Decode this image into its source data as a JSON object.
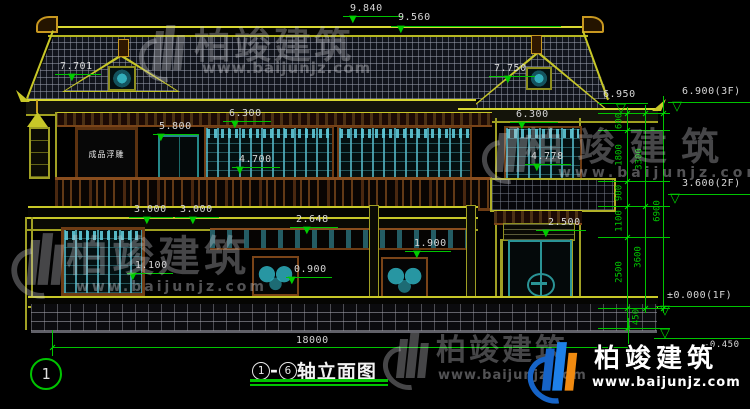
{
  "drawing": {
    "title": {
      "axis_from": "1",
      "axis_to": "6",
      "separator": "-",
      "name": "轴立面图"
    },
    "axis_bubble_label": "1",
    "relief_panel_label": "成品浮雕"
  },
  "levels": {
    "ridge_main": "9.840",
    "ridge_right": "9.560",
    "gable_left": "7.701",
    "gable_right": "7.750",
    "eave_right": "6.950",
    "floor3": "6.900(3F)",
    "floor2": "3.600(2F)",
    "floor1": "±0.000(1F)",
    "ground": "-0.450"
  },
  "facade_dims": {
    "eave_left": "6.300",
    "eave_left2": "6.300",
    "door_2f": "5.800",
    "window_2f": "4.700",
    "window_3f": "4.778",
    "bay1": "3.000",
    "bay2": "3.000",
    "porch_rail": "2.648",
    "door_1f": "2.500",
    "panel_b": "1.900",
    "window_1f": "1.100",
    "panel_a": "0.900",
    "total_width": "18000"
  },
  "chain_dims": {
    "c600": "600",
    "c1800": "1800",
    "c900": "900",
    "c1100": "1100",
    "c2500": "2500",
    "c450": "450",
    "c3300": "3300",
    "c3600": "3600",
    "c6900": "6900"
  },
  "watermark": {
    "brand": "柏竣建筑",
    "url": "www.baijunjz.com"
  },
  "symbols": {
    "arrow_down": "▼",
    "level_mark": "▽"
  },
  "colors": {
    "dim_line": "#00c400",
    "dim_text": "#d6d6d6",
    "outline": "#c8c828",
    "lattice": "#46b4c4",
    "wood": "#6e3c14",
    "brand_blue": "#1664c8",
    "brand_orange": "#f08a10"
  }
}
